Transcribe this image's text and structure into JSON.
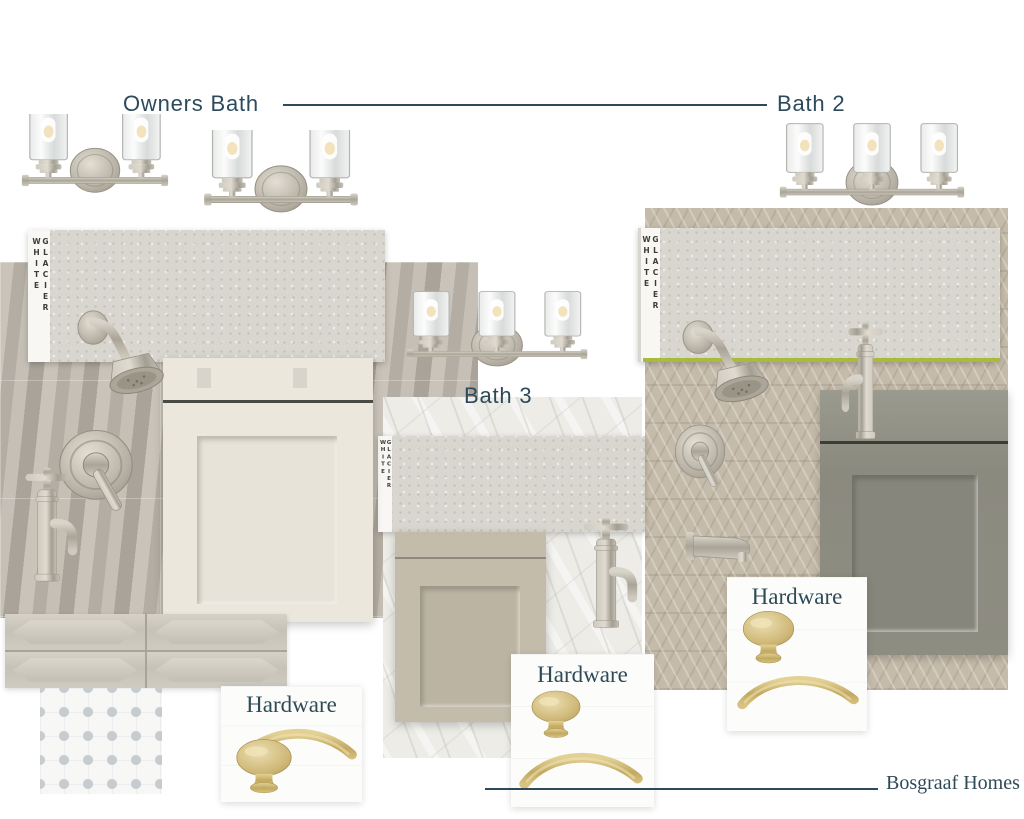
{
  "sections": {
    "owners_bath": {
      "title": "Owners Bath",
      "countertop_label": "GLACIER WHITE",
      "hardware_title": "Hardware"
    },
    "bath_2": {
      "title": "Bath 2",
      "countertop_label": "GLACIER WHITE",
      "hardware_title": "Hardware"
    },
    "bath_3": {
      "title": "Bath 3",
      "countertop_label": "GLACIER WHITE",
      "hardware_title": "Hardware"
    }
  },
  "footer": {
    "brand": "Bosgraaf Homes"
  },
  "colors": {
    "accent_text": "#2d4a5c",
    "brushed_nickel": "#b5afa3",
    "champagne_gold": "#cdb878",
    "highlight_green": "#a9bb3d",
    "quartz_sample": "#d8d6cf",
    "cabinet_owners_bath": "#ebe7dd",
    "cabinet_bath_3": "#c4bcab",
    "cabinet_bath_2": "#8e8d82"
  }
}
